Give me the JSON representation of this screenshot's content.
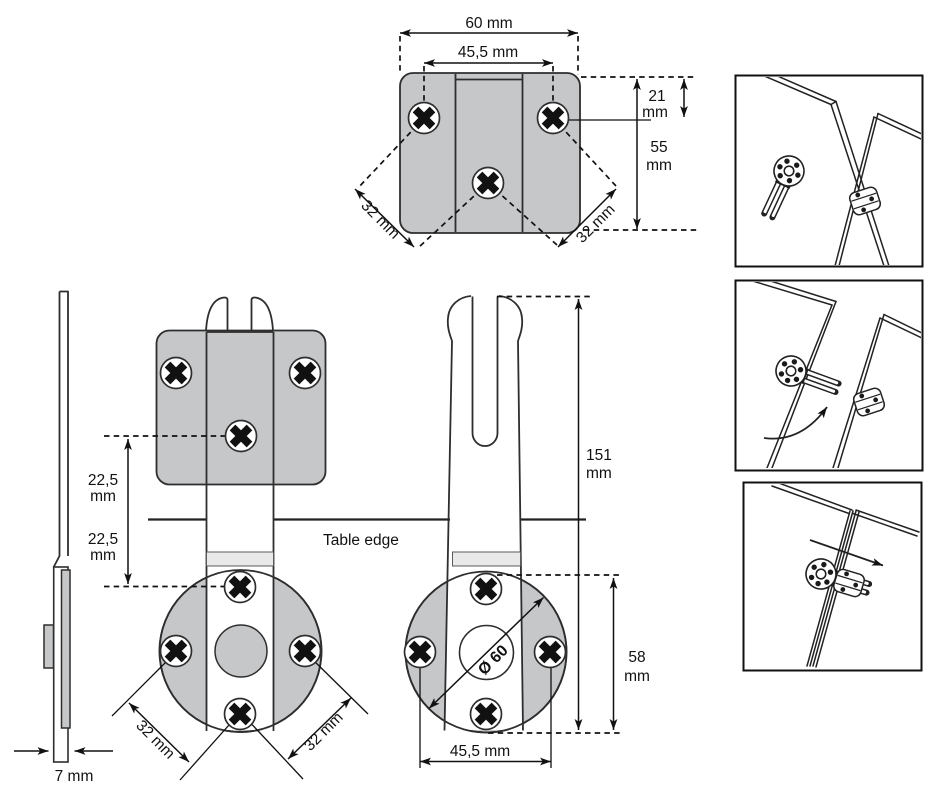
{
  "colors": {
    "plate": "#c5c7c9",
    "band": "#e9e9e9",
    "outline": "#2e2e2e",
    "dim": "#111111"
  },
  "top_view": {
    "overall_width": "60 mm",
    "hole_spacing": "45,5 mm",
    "edge_to_hole": {
      "value": "21",
      "unit": "mm"
    },
    "overall_depth": {
      "value": "55",
      "unit": "mm"
    },
    "diagonal_left": "32 mm",
    "diagonal_right": "32 mm"
  },
  "side_view": {
    "thickness": "7 mm"
  },
  "front_view_mounted": {
    "offset_above_edge": {
      "value": "22,5",
      "unit": "mm"
    },
    "offset_below_edge": {
      "value": "22,5",
      "unit": "mm"
    },
    "diagonal_left": "32 mm",
    "diagonal_right": "32 mm"
  },
  "front_view_connector": {
    "total_length": {
      "value": "151",
      "unit": "mm"
    },
    "disc_center_height": {
      "value": "58",
      "unit": "mm"
    },
    "disc_diameter": "Ø 60",
    "hole_spacing": "45,5 mm"
  },
  "annotations": {
    "table_edge": "Table edge"
  }
}
